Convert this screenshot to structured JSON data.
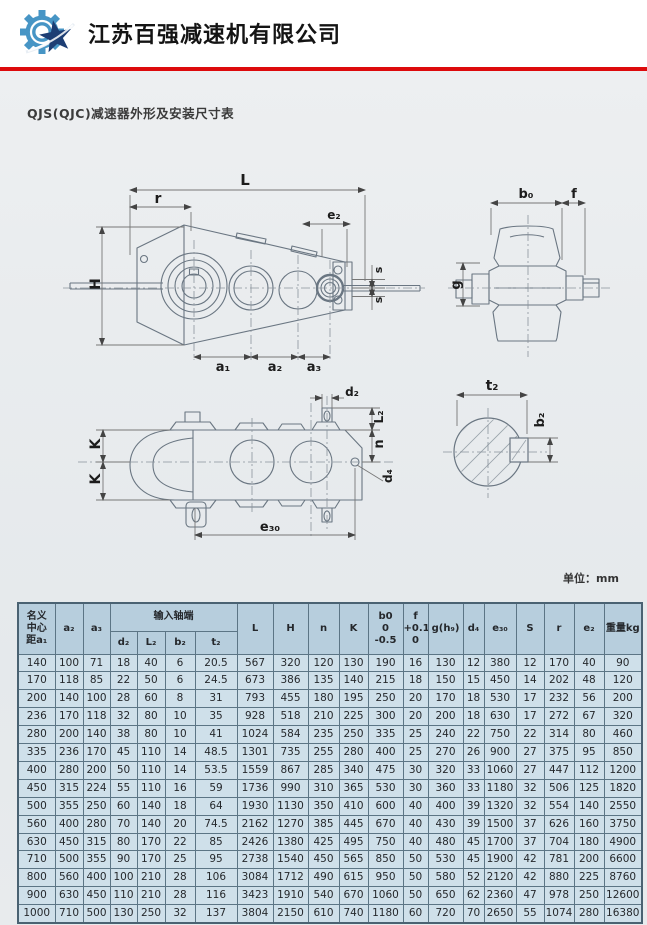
{
  "header": {
    "company_name": "江苏百强减速机有限公司",
    "logo_name": "gear-star-logo",
    "divider_color": "#dd0a0c"
  },
  "document": {
    "title": "QJS(QJC)减速器外形及安装尺寸表",
    "unit_label": "单位：mm"
  },
  "drawings": {
    "side_view": {
      "dim_L": "L",
      "dim_r": "r",
      "dim_e2": "e₂",
      "dim_H": "H",
      "dim_s1": "s",
      "dim_s2": "s",
      "dim_a1": "a₁",
      "dim_a2": "a₂",
      "dim_a3": "a₃"
    },
    "end_view": {
      "dim_b0": "b₀",
      "dim_f": "f",
      "dim_g": "g"
    },
    "plan_view": {
      "dim_K1": "K",
      "dim_K2": "K",
      "dim_d2": "d₂",
      "dim_L2": "L₂",
      "dim_n": "n",
      "dim_d4": "d₄",
      "dim_e30": "e₃₀"
    },
    "shaft_section": {
      "dim_t2": "t₂",
      "dim_b2": "b₂"
    }
  },
  "table": {
    "group_header": "输入轴端",
    "col_nominal": [
      "名义",
      "中心",
      "距a₁"
    ],
    "col_b0": [
      "b0",
      "0",
      "-0.5"
    ],
    "col_f": [
      "f",
      "+0.1",
      "0"
    ],
    "cols": {
      "a2": "a₂",
      "a3": "a₃",
      "d2": "d₂",
      "L2": "L₂",
      "b2": "b₂",
      "t2": "t₂",
      "L": "L",
      "H": "H",
      "n": "n",
      "K": "K",
      "g": "g(h₉)",
      "d4": "d₄",
      "e30": "e₃₀",
      "S": "S",
      "r": "r",
      "e2": "e₂",
      "weight": "重量kg"
    },
    "rows": [
      [
        "140",
        "100",
        "71",
        "18",
        "40",
        "6",
        "20.5",
        "567",
        "320",
        "120",
        "130",
        "190",
        "16",
        "130",
        "12",
        "380",
        "12",
        "170",
        "40",
        "90"
      ],
      [
        "170",
        "118",
        "85",
        "22",
        "50",
        "6",
        "24.5",
        "673",
        "386",
        "135",
        "140",
        "215",
        "18",
        "150",
        "15",
        "450",
        "14",
        "202",
        "48",
        "120"
      ],
      [
        "200",
        "140",
        "100",
        "28",
        "60",
        "8",
        "31",
        "793",
        "455",
        "180",
        "195",
        "250",
        "20",
        "170",
        "18",
        "530",
        "17",
        "232",
        "56",
        "200"
      ],
      [
        "236",
        "170",
        "118",
        "32",
        "80",
        "10",
        "35",
        "928",
        "518",
        "210",
        "225",
        "300",
        "20",
        "200",
        "18",
        "630",
        "17",
        "272",
        "67",
        "320"
      ],
      [
        "280",
        "200",
        "140",
        "38",
        "80",
        "10",
        "41",
        "1024",
        "584",
        "235",
        "250",
        "335",
        "25",
        "240",
        "22",
        "750",
        "22",
        "314",
        "80",
        "460"
      ],
      [
        "335",
        "236",
        "170",
        "45",
        "110",
        "14",
        "48.5",
        "1301",
        "735",
        "255",
        "280",
        "400",
        "25",
        "270",
        "26",
        "900",
        "27",
        "375",
        "95",
        "850"
      ],
      [
        "400",
        "280",
        "200",
        "50",
        "110",
        "14",
        "53.5",
        "1559",
        "867",
        "285",
        "340",
        "475",
        "30",
        "320",
        "33",
        "1060",
        "27",
        "447",
        "112",
        "1200"
      ],
      [
        "450",
        "315",
        "224",
        "55",
        "110",
        "16",
        "59",
        "1736",
        "990",
        "310",
        "365",
        "530",
        "30",
        "360",
        "33",
        "1180",
        "32",
        "506",
        "125",
        "1820"
      ],
      [
        "500",
        "355",
        "250",
        "60",
        "140",
        "18",
        "64",
        "1930",
        "1130",
        "350",
        "410",
        "600",
        "40",
        "400",
        "39",
        "1320",
        "32",
        "554",
        "140",
        "2550"
      ],
      [
        "560",
        "400",
        "280",
        "70",
        "140",
        "20",
        "74.5",
        "2162",
        "1270",
        "385",
        "445",
        "670",
        "40",
        "430",
        "39",
        "1500",
        "37",
        "626",
        "160",
        "3750"
      ],
      [
        "630",
        "450",
        "315",
        "80",
        "170",
        "22",
        "85",
        "2426",
        "1380",
        "425",
        "495",
        "750",
        "40",
        "480",
        "45",
        "1700",
        "37",
        "704",
        "180",
        "4900"
      ],
      [
        "710",
        "500",
        "355",
        "90",
        "170",
        "25",
        "95",
        "2738",
        "1540",
        "450",
        "565",
        "850",
        "50",
        "530",
        "45",
        "1900",
        "42",
        "781",
        "200",
        "6600"
      ],
      [
        "800",
        "560",
        "400",
        "100",
        "210",
        "28",
        "106",
        "3084",
        "1712",
        "490",
        "615",
        "950",
        "50",
        "580",
        "52",
        "2120",
        "42",
        "880",
        "225",
        "8760"
      ],
      [
        "900",
        "630",
        "450",
        "110",
        "210",
        "28",
        "116",
        "3423",
        "1910",
        "540",
        "670",
        "1060",
        "50",
        "650",
        "62",
        "2360",
        "47",
        "978",
        "250",
        "12600"
      ],
      [
        "1000",
        "710",
        "500",
        "130",
        "250",
        "32",
        "137",
        "3804",
        "2150",
        "610",
        "740",
        "1180",
        "60",
        "720",
        "70",
        "2650",
        "55",
        "1074",
        "280",
        "16380"
      ]
    ]
  },
  "colors": {
    "table_cell_bg": "#cfe0ea",
    "table_header_bg": "#b7cedd",
    "table_border": "#5c7585",
    "scan_bg": "#e9ecee",
    "accent_red": "#dd0a0c",
    "logo_blue": "#4795c5",
    "logo_navy": "#1d3e74"
  }
}
